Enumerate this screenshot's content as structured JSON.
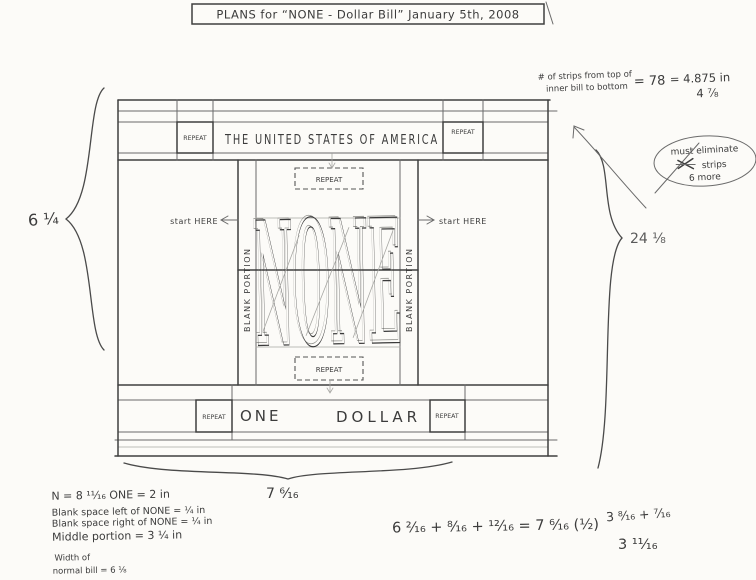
{
  "page": {
    "title": "PLANS  for  “NONE - Dollar Bill”    January 5th, 2008"
  },
  "bill": {
    "repeat": "REPEAT",
    "top_banner": "THE UNITED STATES OF AMERICA",
    "center_word": "NONE",
    "start_here_left": "start HERE",
    "start_here_right": "start HERE",
    "blank_portion": "BLANK PORTION",
    "one": "ONE",
    "dollar": "DOLLAR"
  },
  "annotations": {
    "strips_line1": "# of strips from top of",
    "strips_line2": "inner bill to bottom",
    "strips_count": "= 78",
    "strips_inches": "= 4.875 in",
    "strips_fraction": "4 ⅞",
    "eliminate_line1": "must eliminate",
    "eliminate_line2": "strips",
    "eliminate_line3": "6 more",
    "height_left": "6 ¼",
    "strips_right": "24 ⅛",
    "width_bottom": "7 ⁶⁄₁₆"
  },
  "footnotes": {
    "line1": "N = 8 ¹¹⁄₁₆    ONE = 2 in",
    "line2": "Blank space left of NONE = ¼ in",
    "line3": "Blank space right of NONE = ¼ in",
    "line4": "Middle portion = 3 ¼ in",
    "line5": "Width of",
    "line6": "normal bill = 6 ⅛"
  },
  "equations": {
    "sum": "6 ²⁄₁₆ + ⁸⁄₁₆ + ¹²⁄₁₆  =  7 ⁶⁄₁₆ (½)",
    "right_top": "3 ⁸⁄₁₆ + ⁷⁄₁₆",
    "right_bottom": "3 ¹¹⁄₁₆"
  }
}
